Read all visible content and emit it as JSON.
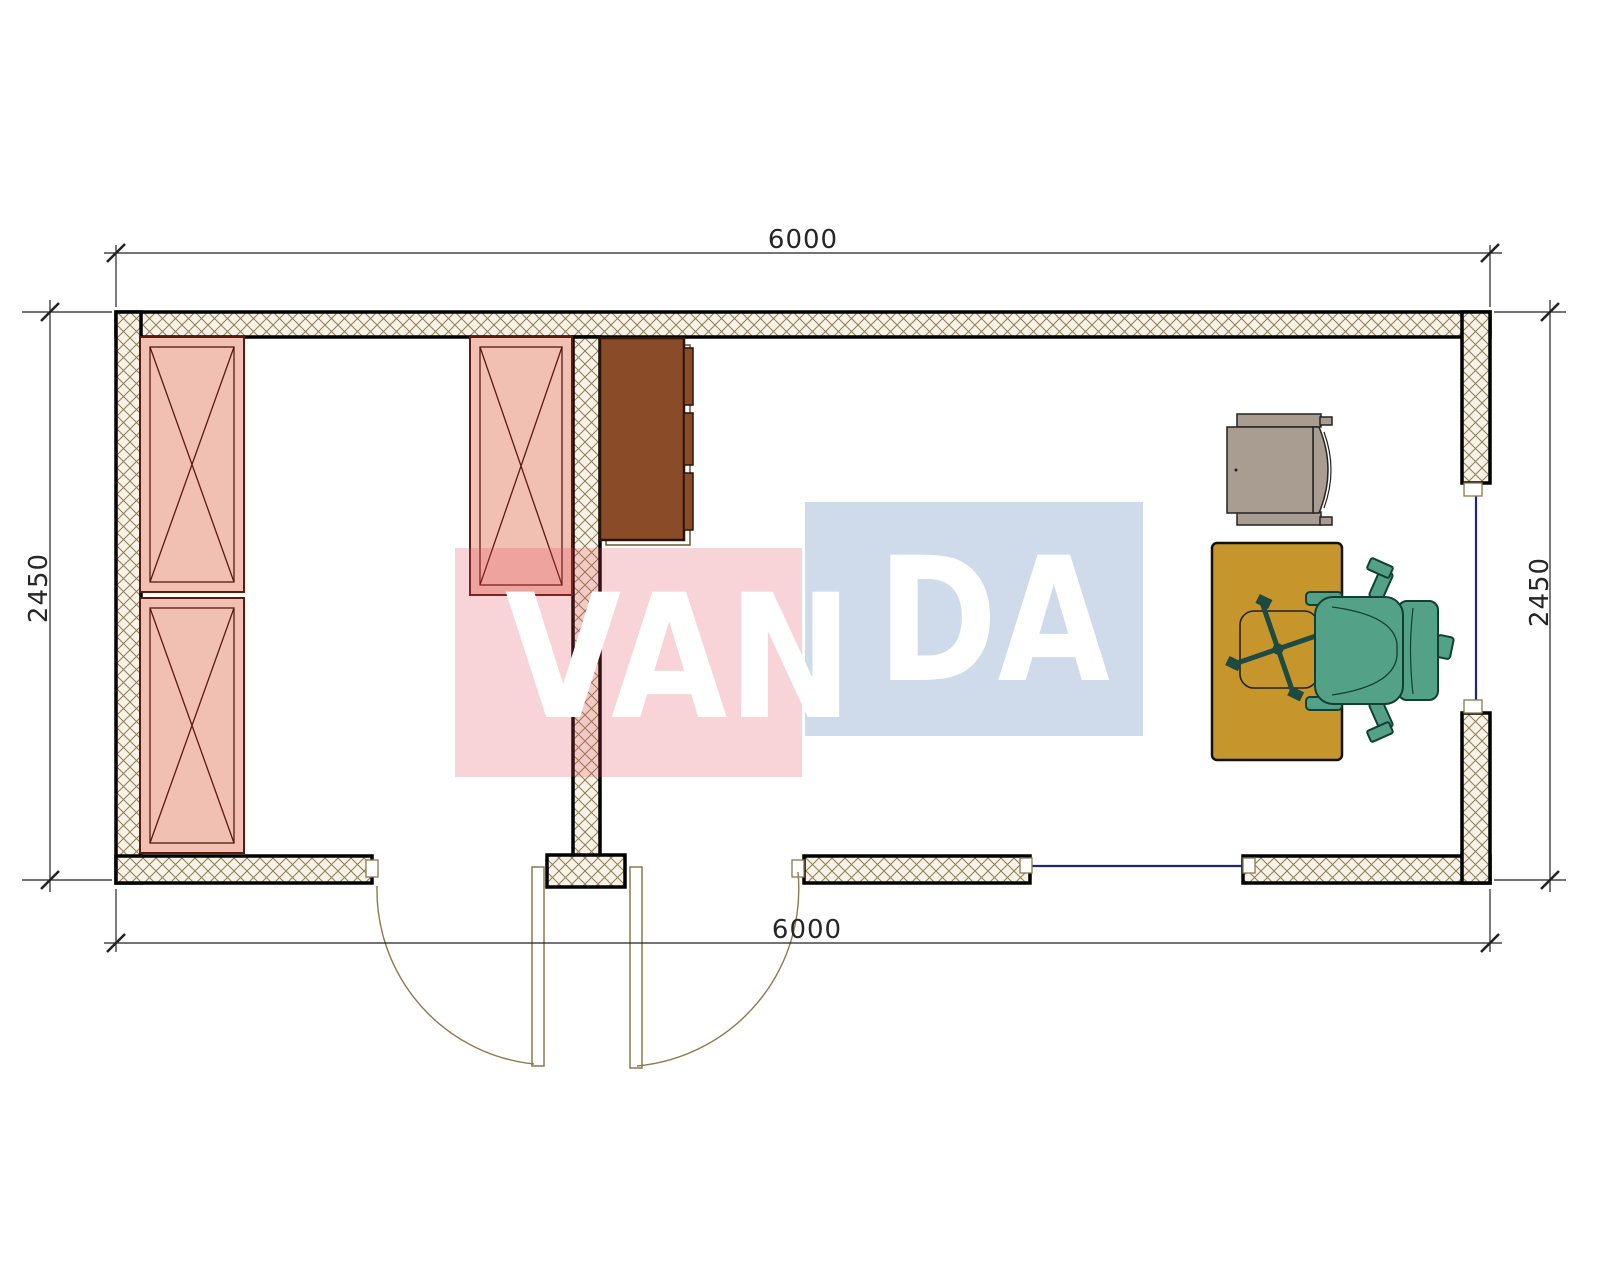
{
  "dimensions": {
    "top": "6000",
    "bottom": "6000",
    "left": "2450",
    "right": "2450"
  },
  "watermark": {
    "text": "VANDA",
    "left_part": "VAN",
    "right_part": "DA"
  },
  "colors": {
    "wall_outline": "#000000",
    "wall_hatch_bg": "#f8f3e6",
    "wall_hatch_line": "#8d7d57",
    "storage_unit_fill": "#f2bfb3",
    "storage_unit_border": "#591a10",
    "cabinet_fill": "#8a4b28",
    "cabinet_border": "#2a140a",
    "desk_fill": "#c6952c",
    "armchair_fill": "#a99d92",
    "office_chair_fill": "#53a287",
    "office_chair_border": "#123f32",
    "chair_base_color": "#1d4a41",
    "window_glass_line": "#23237a",
    "door_swing_line": "#8a7a50",
    "dimension_line": "#222222",
    "watermark_red_block": "#e04b5a",
    "watermark_blue_block": "#4673af",
    "watermark_text": "#ffffff"
  }
}
